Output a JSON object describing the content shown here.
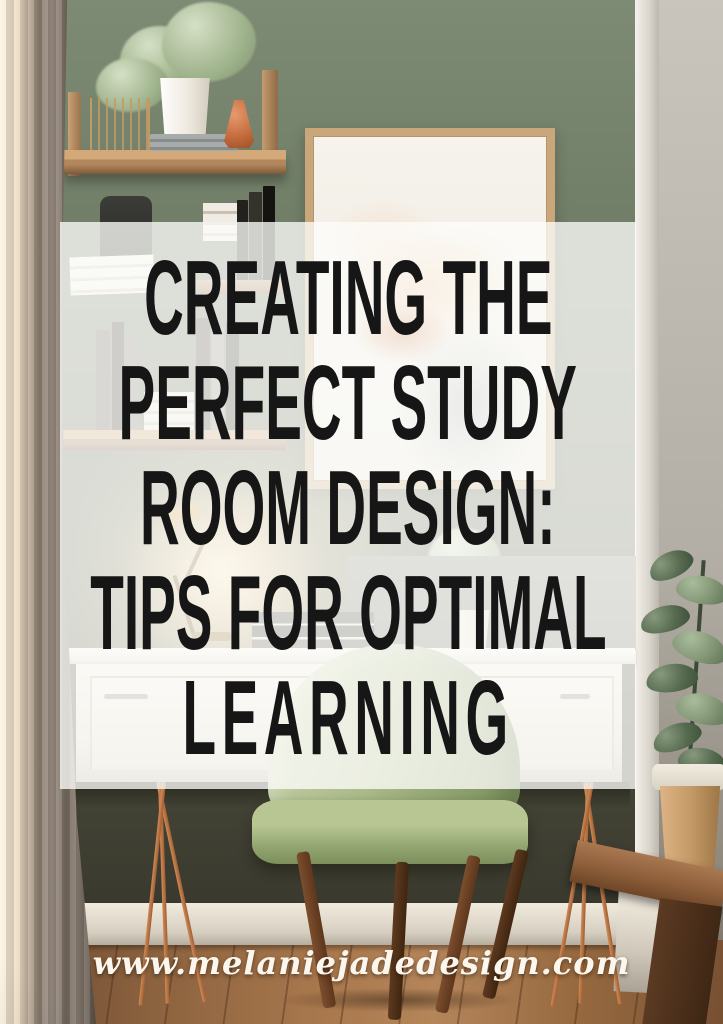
{
  "graphic": {
    "title": {
      "lines": [
        "CREATING THE",
        "PERFECT STUDY",
        "ROOM DESIGN:",
        "TIPS FOR OPTIMAL",
        "LEARNING"
      ],
      "text_color": "#161616",
      "panel_color": "rgba(252,253,250,0.78)"
    },
    "footer": {
      "website": "www.melaniejadedesign.com",
      "text_color": "#fcf7ee"
    },
    "photo": {
      "subject": "study-nook-with-desk-green-chair-shelves-and-plants",
      "palette": {
        "wall_green": "#6d7a64",
        "wall_gray": "#b3aea5",
        "curtain_taupe": "#8f8274",
        "shelf_wood": "#b3875d",
        "copper_legs": "#c07848",
        "chair_green": "#aebd8c",
        "floor_wood": "#a9784d",
        "terracotta_vase": "#c36b3c",
        "art_orange": "#c66a34"
      }
    }
  }
}
